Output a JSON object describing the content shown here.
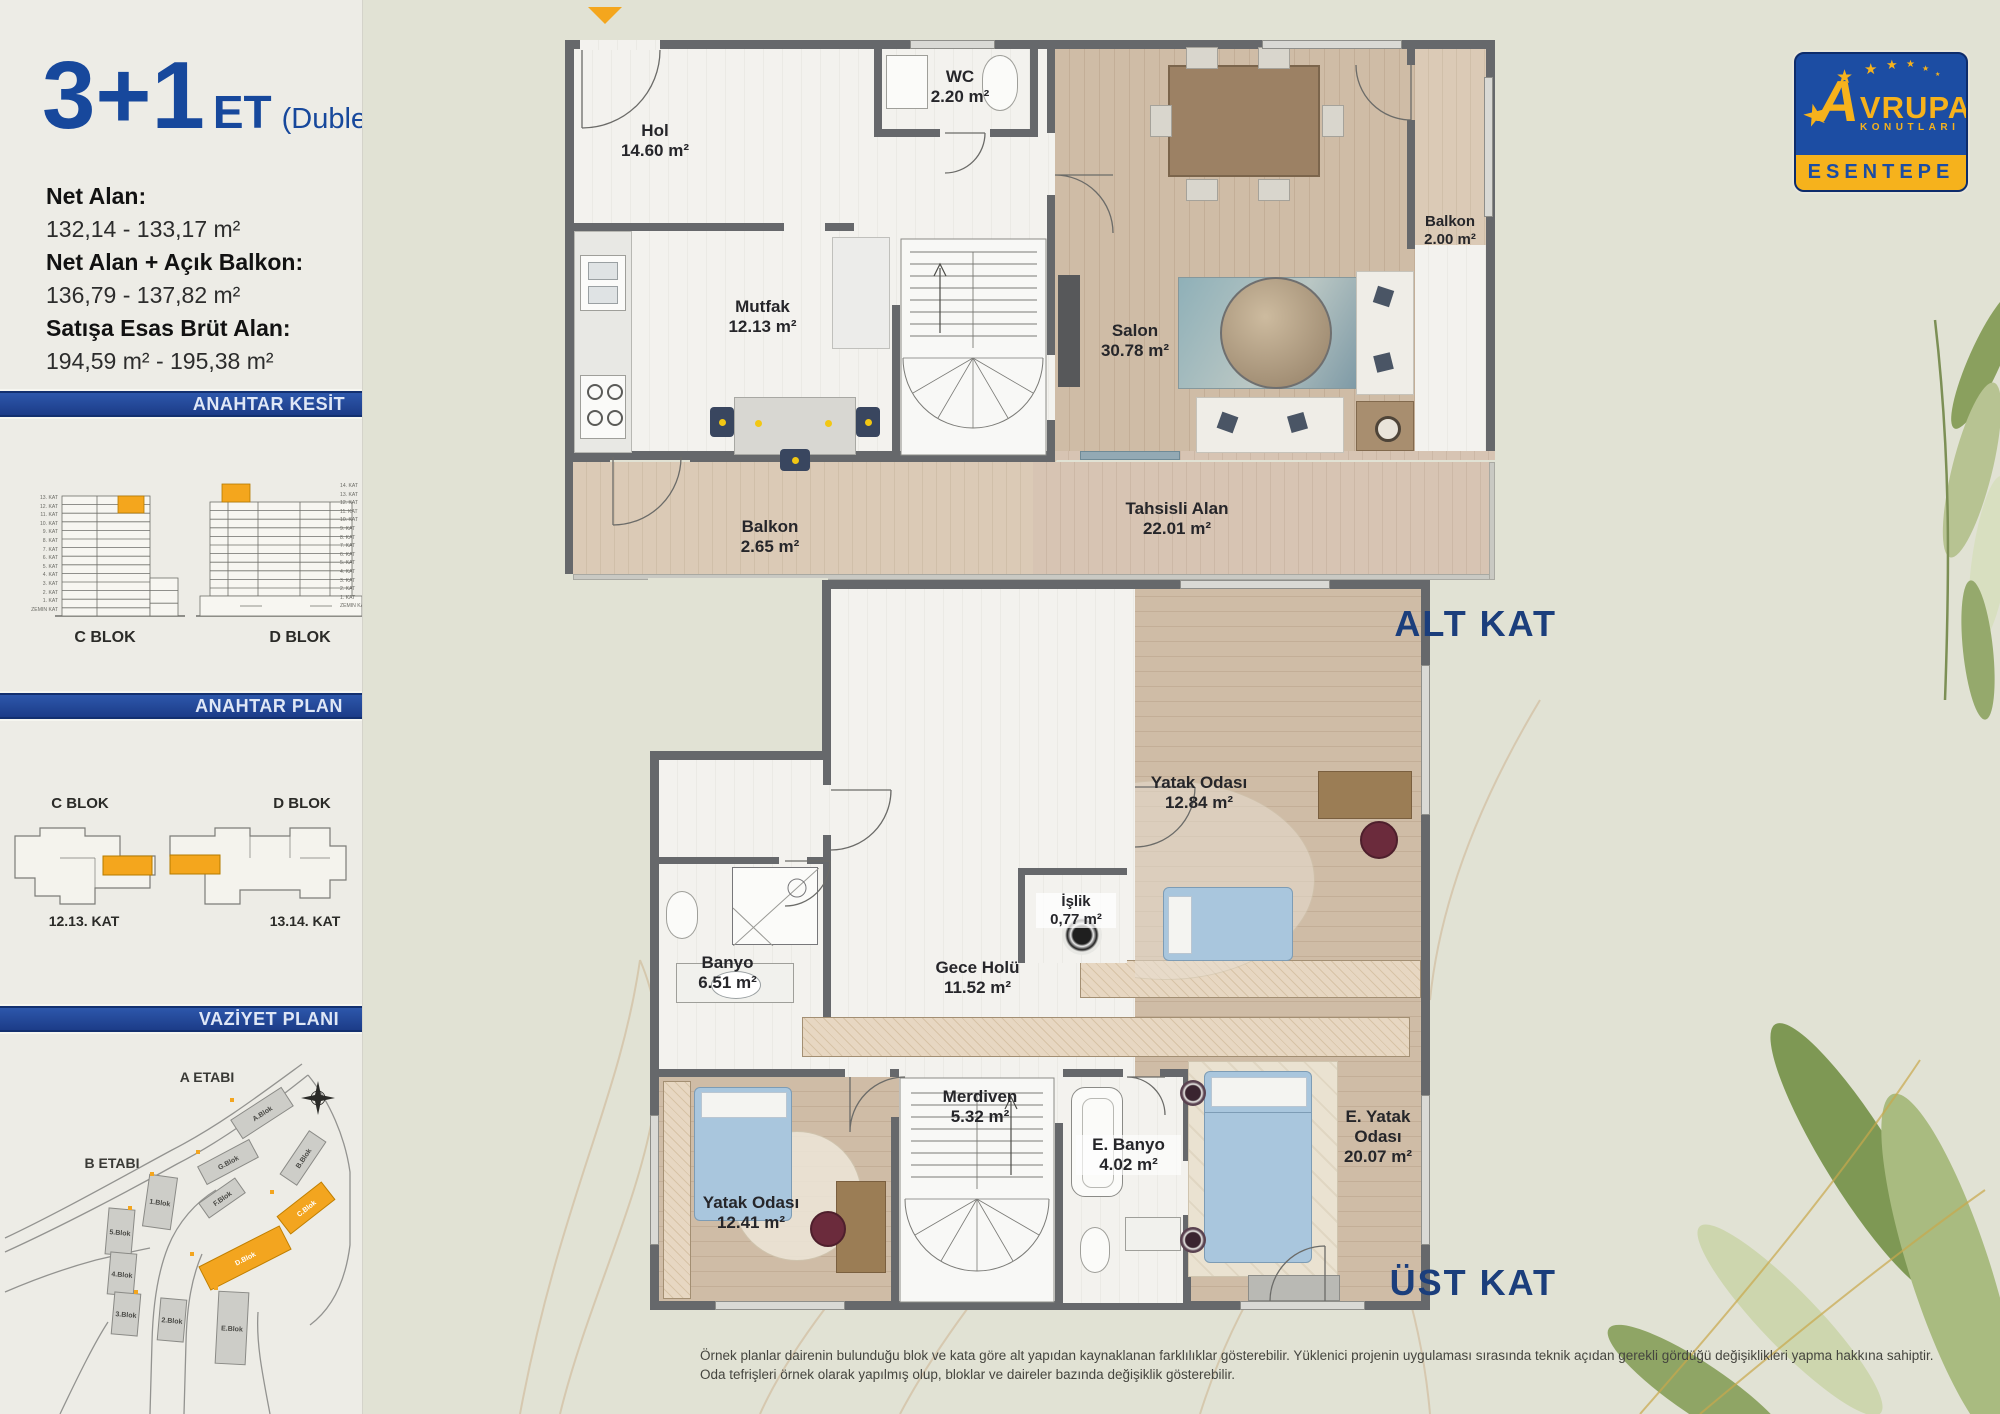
{
  "sidebar": {
    "title_main": "3+1",
    "title_suffix": "ET",
    "title_note": "(Dublex)",
    "areas": [
      {
        "label": "Net Alan:",
        "value": "132,14 - 133,17 m²"
      },
      {
        "label": "Net Alan + Açık Balkon:",
        "value": "136,79 - 137,82 m²"
      },
      {
        "label": "Satışa Esas Brüt Alan:",
        "value": "194,59 m² - 195,38 m²"
      }
    ],
    "kesit": {
      "title": "ANAHTAR KESİT",
      "c_label": "C BLOK",
      "d_label": "D BLOK",
      "c_floors": [
        "13. KAT",
        "12. KAT",
        "11. KAT",
        "10. KAT",
        "9. KAT",
        "8. KAT",
        "7. KAT",
        "6. KAT",
        "5. KAT",
        "4. KAT",
        "3. KAT",
        "2. KAT",
        "1. KAT",
        "ZEMİN KAT"
      ],
      "d_floors": [
        "14. KAT",
        "13. KAT",
        "12. KAT",
        "11. KAT",
        "10. KAT",
        "9. KAT",
        "8. KAT",
        "7. KAT",
        "6. KAT",
        "5. KAT",
        "4. KAT",
        "3. KAT",
        "2. KAT",
        "1. KAT",
        "ZEMİN KAT"
      ]
    },
    "anahtar_plan": {
      "title": "ANAHTAR PLAN",
      "c_label": "C BLOK",
      "d_label": "D BLOK",
      "c_floor": "12.13. KAT",
      "d_floor": "13.14. KAT"
    },
    "vaziyet": {
      "title": "VAZİYET PLANI",
      "etap_a": "A ETABI",
      "etap_b": "B ETABI",
      "blocks": [
        {
          "name": "A.Blok"
        },
        {
          "name": "G.Blok"
        },
        {
          "name": "B.Blok"
        },
        {
          "name": "C.Blok"
        },
        {
          "name": "1.Blok"
        },
        {
          "name": "F.Blok"
        },
        {
          "name": "D.Blok"
        },
        {
          "name": "5.Blok"
        },
        {
          "name": "4.Blok"
        },
        {
          "name": "3.Blok"
        },
        {
          "name": "2.Blok"
        },
        {
          "name": "E.Blok"
        }
      ]
    }
  },
  "logo": {
    "brand_a": "A",
    "brand_rest": "VRUPA",
    "brand_sub": "KONUTLARI",
    "project": "ESENTEPE"
  },
  "floors": {
    "alt": {
      "caption": "ALT KAT",
      "rooms": {
        "wc": {
          "name": "WC",
          "area": "2.20 m²"
        },
        "hol": {
          "name": "Hol",
          "area": "14.60 m²"
        },
        "mutfak": {
          "name": "Mutfak",
          "area": "12.13 m²"
        },
        "salon": {
          "name": "Salon",
          "area": "30.78 m²"
        },
        "balkon_sag": {
          "name": "Balkon",
          "area": "2.00 m²"
        },
        "balkon_alt": {
          "name": "Balkon",
          "area": "2.65 m²"
        },
        "tahsisli": {
          "name": "Tahsisli Alan",
          "area": "22.01 m²"
        }
      }
    },
    "ust": {
      "caption": "ÜST KAT",
      "rooms": {
        "yatak1": {
          "name": "Yatak Odası",
          "area": "12.84 m²"
        },
        "islik": {
          "name": "İşlik",
          "area": "0,77 m²"
        },
        "banyo": {
          "name": "Banyo",
          "area": "6.51 m²"
        },
        "gece_holu": {
          "name": "Gece Holü",
          "area": "11.52 m²"
        },
        "merdiven": {
          "name": "Merdiven",
          "area": "5.32 m²"
        },
        "e_banyo": {
          "name": "E. Banyo",
          "area": "4.02 m²"
        },
        "e_yatak": {
          "name": "E. Yatak Odası",
          "area": "20.07 m²"
        },
        "yatak2": {
          "name": "Yatak Odası",
          "area": "12.41 m²"
        }
      }
    }
  },
  "disclaimer": {
    "line1": "Örnek planlar dairenin bulunduğu blok ve kata göre alt yapıdan kaynaklanan farklılıklar gösterebilir. Yüklenici projenin uygulaması sırasında teknik açıdan gerekli gördüğü değişiklikleri yapma hakkına sahiptir.",
    "line2": "Oda tefrişleri örnek olarak yapılmış olup, bloklar ve daireler bazında değişiklik gösterebilir."
  },
  "colors": {
    "accent_orange": "#F4A61D",
    "banner_blue": "#1E3F8F",
    "title_blue": "#17489C",
    "caption_blue": "#1B3E7C"
  }
}
